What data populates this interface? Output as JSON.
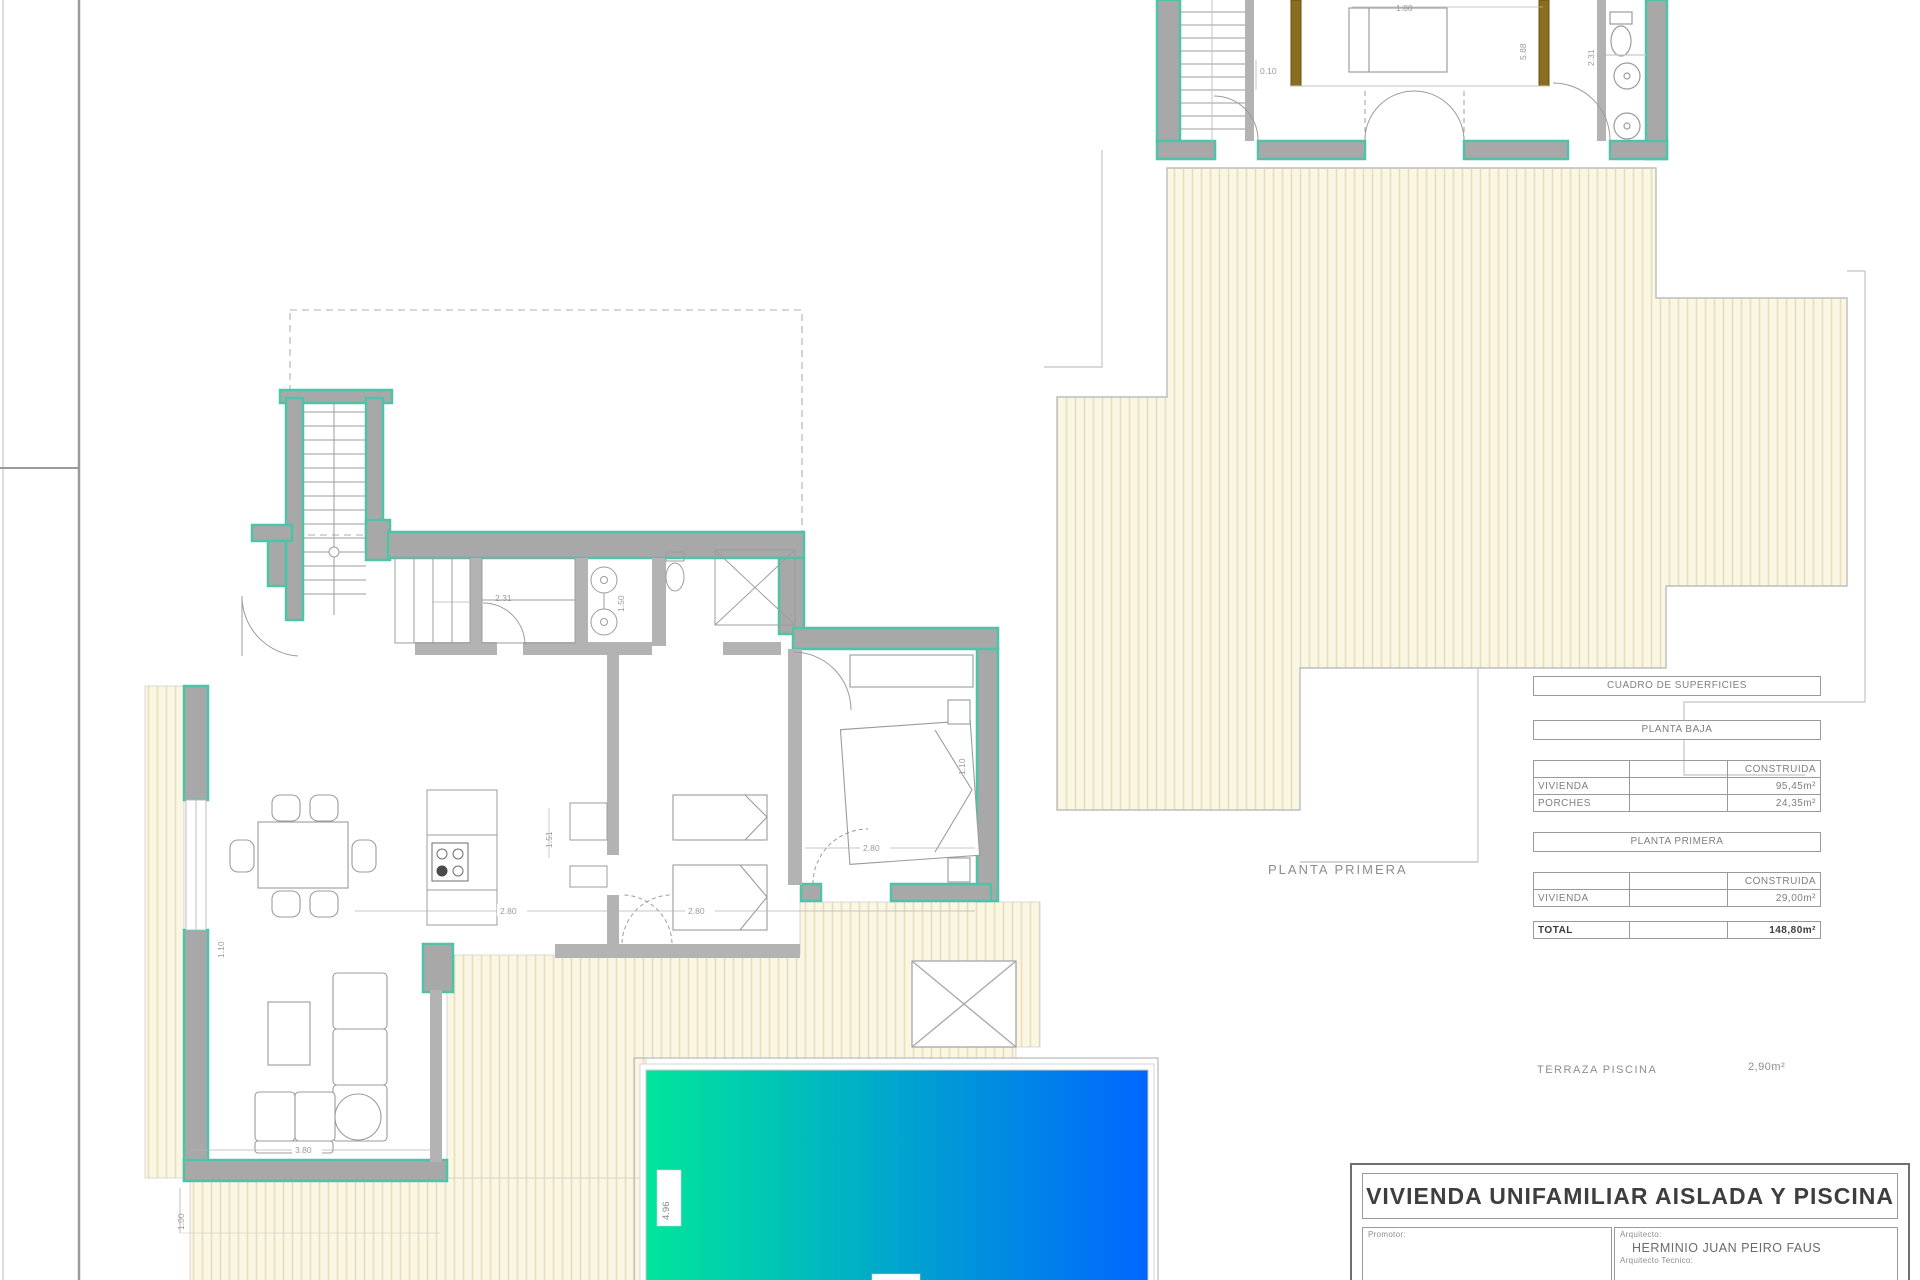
{
  "colors": {
    "teal_wall": "#4EC3A8",
    "wall_gray": "#A8A8A8",
    "hatch_bg": "#FAF6E4",
    "hatch_line": "#E6DFB8",
    "pool_gradient_start": "#00E59B",
    "pool_gradient_end": "#0066FF",
    "wood_brown": "#8A6D1F",
    "outline_gray": "#B8B8B8",
    "dim_text": "#9B9B9B"
  },
  "plan_labels": {
    "planta_primera": "PLANTA PRIMERA",
    "terraza_piscina": "TERRAZA PISCINA",
    "terraza_area": "2,90m²"
  },
  "area_table": {
    "title": "CUADRO DE SUPERFICIES",
    "section1_heading": "PLANTA BAJA",
    "section1_col": "CONSTRUIDA",
    "s1_r1_label": "VIVIENDA",
    "s1_r1_value": "95,45m²",
    "s1_r2_label": "PORCHES",
    "s1_r2_value": "24,35m²",
    "section2_heading": "PLANTA PRIMERA",
    "section2_col": "CONSTRUIDA",
    "s2_r1_label": "VIVIENDA",
    "s2_r1_value": "29,00m²",
    "total_label": "TOTAL",
    "total_value": "148,80m²"
  },
  "title_block": {
    "project_title": "VIVIENDA UNIFAMILIAR AISLADA Y PISCINA",
    "promoter_label": "Promotor:",
    "architect_label": "Arquitecto:",
    "architect_name": "HERMINIO JUAN PEIRO FAUS",
    "technical_architect_label": "Arquitecto Tecnico:"
  },
  "dimensions": {
    "gf_closet": "2.31",
    "gf_bath_v": "1.50",
    "gf_hall_left": "2.80",
    "gf_hall_right": "2.80",
    "gf_bedroom": "2.80",
    "gf_bedroom_v": "1.10",
    "gf_living": "3.80",
    "gf_kitchen_v": "1.51",
    "gf_wall_v": "1.10",
    "gf_porch_v": "1.00",
    "pool_width": "4.96",
    "ff_bed": "1.80",
    "ff_stair": "0.10",
    "ff_room_v": "5.88",
    "ff_bath_v": "2.31"
  }
}
